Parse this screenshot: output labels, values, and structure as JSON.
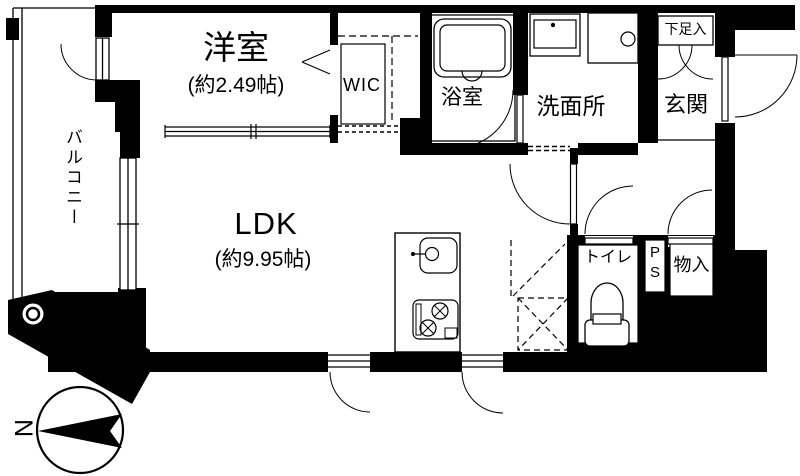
{
  "plan": {
    "title": "apartment-floor-plan",
    "rooms": {
      "western_room": {
        "label": "洋室",
        "area": "(約2.49帖)"
      },
      "ldk": {
        "label": "LDK",
        "area": "(約9.95帖)"
      },
      "wic": {
        "label": "WIC"
      },
      "bathroom": {
        "label": "浴室"
      },
      "washroom": {
        "label": "洗面所"
      },
      "entrance": {
        "label": "玄関"
      },
      "shoe_storage": {
        "label": "下足入"
      },
      "balcony": {
        "label": "バルコニー"
      },
      "toilet": {
        "label": "トイレ"
      },
      "pipe_space": {
        "label": "PS",
        "line1": "P",
        "line2": "S"
      },
      "storage": {
        "label": "物入"
      }
    },
    "compass": {
      "label": "N"
    },
    "colors": {
      "wall": "#000000",
      "background": "#ffffff",
      "line": "#000000"
    }
  }
}
